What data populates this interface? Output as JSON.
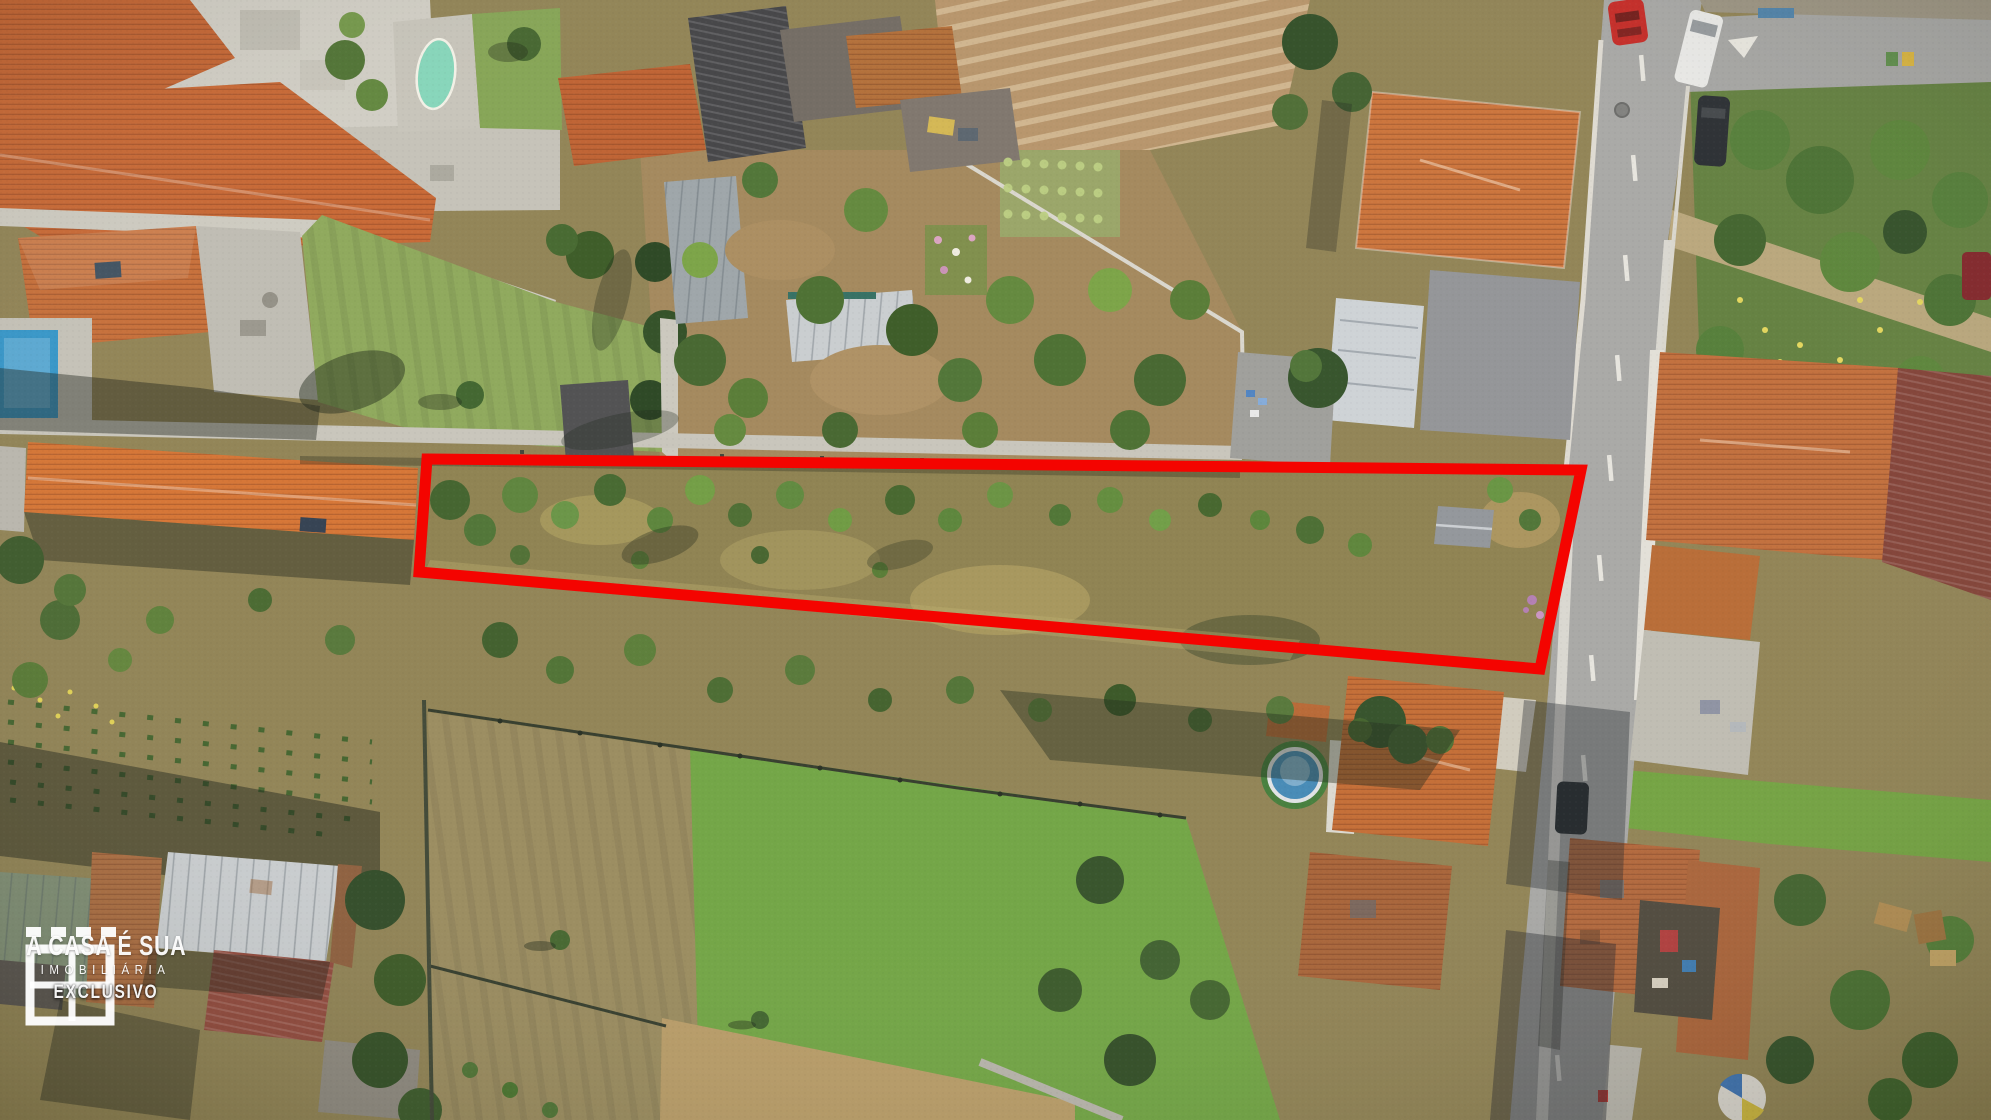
{
  "image": {
    "kind": "aerial-drone-photo",
    "subject": "vacant land parcel highlighted with red boundary in a residential village",
    "width_px": 1991,
    "height_px": 1120
  },
  "watermark": {
    "icon": "window-logo-icon",
    "brand": "A CASA É SUA",
    "subtitle": "IMOBILIÁRIA",
    "badge": "EXCLUSIVO",
    "text_color": "#ffffff"
  },
  "annotation": {
    "label": "property-boundary-highlight",
    "outline_points": "427,459 1581,470 1540,669 419,572",
    "outline_color": "#f40400",
    "outline_stroke_width": 11
  },
  "scene": {
    "landmarks": [
      "row houses with orange tiled roofs (top left)",
      "oval mint swimming pool and rectangular blue pool",
      "large mowed lawn with trees",
      "vegetable gardens and grey sheds (top centre)",
      "brown tilled field with furrows",
      "large hip-roof house (top right)",
      "main road with red car, white van and dark car",
      "highlighted scrub parcel with bushes and small grey shed",
      "green and dry meadows below the parcel",
      "warehouse and old tiled roofs (bottom left)",
      "house with round blue pool (bottom centre-right)",
      "courtyard house and overgrown garden (bottom right)"
    ],
    "palette": {
      "roof_orange": "#c56a32",
      "lawn_green": "#8aa556",
      "meadow_green": "#6da23f",
      "dry_field": "#a89460",
      "tilled_soil": "#b49166",
      "road_grey": "#a5a5a3",
      "pool_blue": "#3f86b4",
      "pool_mint": "#82d4b8"
    }
  }
}
